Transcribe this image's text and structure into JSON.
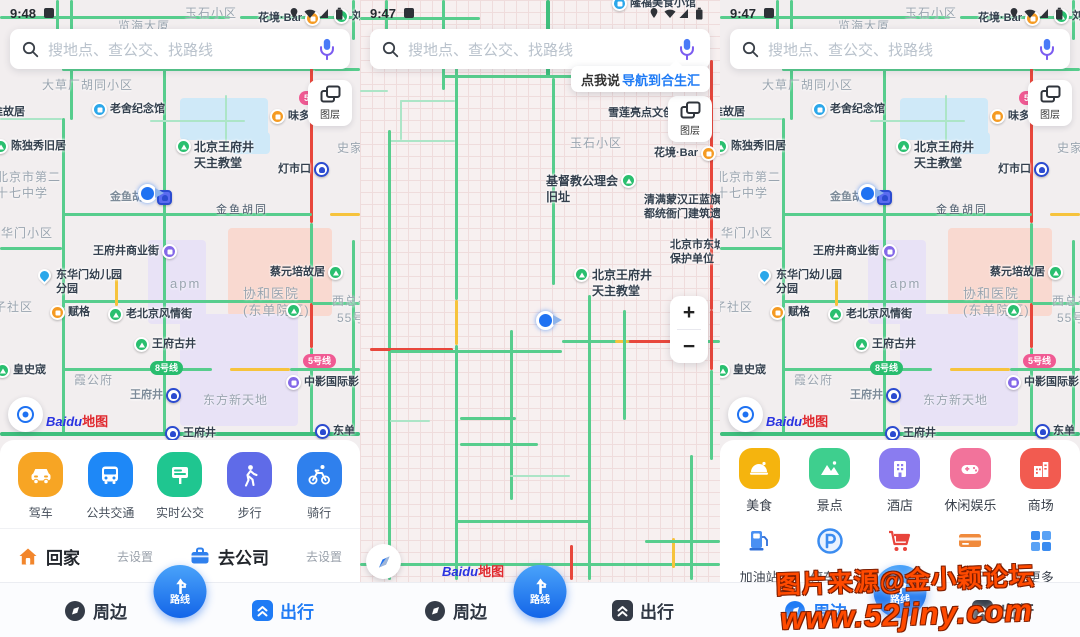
{
  "colors": {
    "accent_blue": "#1F7BF5",
    "traffic_green": "#57CD8D",
    "traffic_red": "#E8473C",
    "traffic_yellow": "#F6C33C",
    "brand_baidu_blue": "#2932E1",
    "brand_baidu_red": "#E0282E",
    "poi_green": "#2ABF6F",
    "poi_blue": "#2BA7EA",
    "poi_orange": "#F59B23",
    "poi_purple": "#8468E8",
    "badge_pink": "#F05A93",
    "badge_green": "#29BD6E",
    "watermark_red": "#FF4A00"
  },
  "status": {
    "time_left": "9:48",
    "time_mid": "9:47",
    "time_right": "9:47"
  },
  "search": {
    "placeholder": "搜地点、查公交、找路线"
  },
  "layers": {
    "label": "图层"
  },
  "voice_tip": {
    "prefix": "点我说",
    "action": "导航到合生汇"
  },
  "zoom_control": {
    "zoom_in": "+",
    "zoom_out": "−"
  },
  "logo": {
    "bai": "Baidu",
    "map": "地图"
  },
  "map_wfj": {
    "labels": {
      "yushi": "玉石小区",
      "lanhai": "览海大厦",
      "huajing": "花境·Bar",
      "liu": "刘",
      "dacaochang": "大草厂胡同小区",
      "guju": "准故居",
      "laoshe": "老舍纪念馆",
      "weiduomei": "味多美",
      "line5_badge": "5号",
      "chenduxiu": "陈独秀旧居",
      "shijia": "史家",
      "church_1": "北京王府井",
      "church_2": "天主教堂",
      "dengshikou": "灯市口",
      "school_1": "北京市第二",
      "school_2": "十七中学",
      "jinyu_st": "金鱼胡同",
      "jinyu_rd": "金鱼胡同",
      "donghuamen_xq": "东华门小区",
      "wfj_biz": "王府井商业街",
      "caiyuanpei": "蔡元培故居",
      "apm": "apm",
      "kindergarten_1": "东华门幼儿园",
      "kindergarten_2": "分园",
      "zishequ": "子社区",
      "fuge": "赋格",
      "laobeijing": "老北京风情街",
      "wangfugujing": "王府古井",
      "xiehe_1": "协和医院",
      "xiehe_2": "(东单院区)",
      "xizongbu": "西总布",
      "no55": "55号",
      "huangshicheng": "皇史宬",
      "xiagongfu": "霞公府",
      "line8": "8号线",
      "line5": "5号线",
      "zhongying": "中影国际影",
      "wfj_station": "王府井",
      "oriental_plaza": "东方新天地",
      "wfj_station2": "王府井",
      "dongdan": "东单"
    }
  },
  "map_mid": {
    "labels": {
      "longfu": "隆福美食小馆",
      "xuelian": "雪莲亮点文创园",
      "yushi": "玉石小区",
      "huajing": "花境·Bar",
      "church_a": "基督教公理会",
      "church_b": "旧址",
      "yamen_1": "清满蒙汉正蓝旗",
      "yamen_2": "都统衙门建筑遗址",
      "dongcheng_1": "北京市东城",
      "dongcheng_2": "保护单位",
      "wfj_church_1": "北京王府井",
      "wfj_church_2": "天主教堂"
    }
  },
  "panel_left": {
    "transport": [
      {
        "label": "驾车"
      },
      {
        "label": "公共交通"
      },
      {
        "label": "实时公交"
      },
      {
        "label": "步行"
      },
      {
        "label": "骑行"
      }
    ],
    "shortcuts": {
      "home": "回家",
      "home_action": "去设置",
      "company": "去公司",
      "company_action": "去设置"
    },
    "nav": {
      "nearby": "周边",
      "route": "路线",
      "trip": "出行"
    }
  },
  "panel_mid": {
    "nav": {
      "nearby": "周边",
      "route": "路线",
      "trip": "出行"
    }
  },
  "panel_right": {
    "categories": [
      {
        "label": "美食"
      },
      {
        "label": "景点"
      },
      {
        "label": "酒店"
      },
      {
        "label": "休闲娱乐"
      },
      {
        "label": "商场"
      },
      {
        "label": "加油站"
      },
      {
        "label": "停车场"
      },
      {
        "label": "超市"
      },
      {
        "label": "银行"
      },
      {
        "label": "更多"
      }
    ],
    "nav": {
      "nearby": "周边",
      "route": "路线",
      "trip": "出行"
    }
  },
  "watermark": {
    "line1": "图片来源@金小颖论坛",
    "line2": "www.52jiny.com"
  }
}
